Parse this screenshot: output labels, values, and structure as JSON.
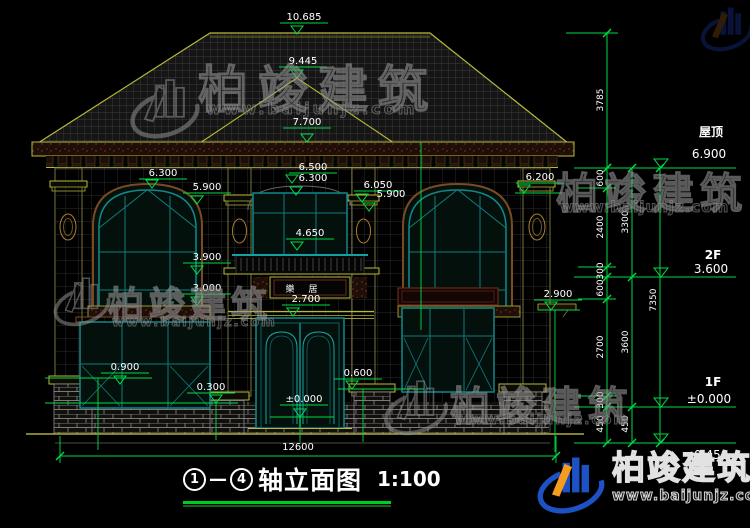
{
  "watermark": {
    "brand": "柏竣建筑",
    "url": "www.baijunjz.com"
  },
  "title": {
    "axis_start": "1",
    "separator": "—",
    "axis_end": "4",
    "name": "轴立面图",
    "scale": "1:100"
  },
  "plaque": {
    "char1": "樂",
    "char2": "居"
  },
  "colors": {
    "background": "#000000",
    "dimension_green": "#00dd44",
    "text_white": "#ffffff",
    "frame_teal": "#128989",
    "trim_olive": "#b9b93a",
    "brand_blue": "#1c52c4",
    "brand_orange": "#f59b1f",
    "watermark_gray": "#969696"
  },
  "annotations": {
    "spot_markers": [
      {
        "label": "10.685",
        "x": 304,
        "y": 20,
        "tx": 297,
        "ty": 34
      },
      {
        "label": "9.445",
        "x": 303,
        "y": 64,
        "tx": 297,
        "ty": 78
      },
      {
        "label": "7.700",
        "x": 307,
        "y": 125,
        "tx": 307,
        "ty": 142
      },
      {
        "label": "6.300",
        "x": 163,
        "y": 176,
        "tx": 152,
        "ty": 188
      },
      {
        "label": "5.900",
        "x": 207,
        "y": 190,
        "tx": 197,
        "ty": 204
      },
      {
        "label": "6.500",
        "x": 313,
        "y": 170,
        "tx": 292,
        "ty": 183
      },
      {
        "label": "6.300",
        "x": 313,
        "y": 181,
        "ul": false,
        "tx": 296,
        "ty": 195
      },
      {
        "label": "6.050",
        "x": 378,
        "y": 188,
        "tx": 362,
        "ty": 202
      },
      {
        "label": "5.900",
        "x": 391,
        "y": 197,
        "ul": false,
        "tx": 369,
        "ty": 211
      },
      {
        "label": "6.200",
        "x": 540,
        "y": 180,
        "tx": 524,
        "ty": 193
      },
      {
        "label": "4.650",
        "x": 310,
        "y": 236,
        "tx": 297,
        "ty": 250
      },
      {
        "label": "3.900",
        "x": 207,
        "y": 260,
        "tx": 197,
        "ty": 274
      },
      {
        "label": "3.000",
        "x": 207,
        "y": 291,
        "tx": 197,
        "ty": 305
      },
      {
        "label": "2.900",
        "x": 558,
        "y": 297,
        "tx": 551,
        "ty": 310
      },
      {
        "label": "2.700",
        "x": 306,
        "y": 302,
        "tx": 293,
        "ty": 316
      },
      {
        "label": "0.900",
        "x": 125,
        "y": 370,
        "tx": 120,
        "ty": 384
      },
      {
        "label": "0.300",
        "x": 211,
        "y": 390,
        "tx": 216,
        "ty": 403
      },
      {
        "label": "0.600",
        "x": 358,
        "y": 376,
        "tx": 352,
        "ty": 389
      },
      {
        "label": "±0.000",
        "x": 304,
        "y": 402,
        "tx": 300,
        "ty": 417
      }
    ],
    "levels": [
      {
        "name": "屋顶",
        "value": "6.900",
        "line_y": 168,
        "name_x": 711,
        "name_y": 136,
        "value_x": 709,
        "value_y": 158
      },
      {
        "name": "2F",
        "value": "3.600",
        "line_y": 277,
        "name_x": 713,
        "name_y": 259,
        "value_x": 711,
        "value_y": 273
      },
      {
        "name": "1F",
        "value": "±0.000",
        "line_y": 407,
        "name_x": 713,
        "name_y": 386,
        "value_x": 709,
        "value_y": 403
      },
      {
        "name": "",
        "value": "-0.450",
        "line_y": 443,
        "name_x": 0,
        "name_y": 0,
        "value_x": 709,
        "value_y": 459
      }
    ],
    "chains": [
      {
        "x": 607,
        "y1": 33,
        "y2": 168,
        "ticks": [
          33,
          168
        ],
        "labels": [
          {
            "text": "3785",
            "y": 100
          }
        ]
      },
      {
        "x": 607,
        "y1": 168,
        "y2": 443,
        "ticks": [
          168,
          188,
          267,
          277,
          299,
          396,
          407,
          443
        ],
        "labels": [
          {
            "text": "600",
            "y": 178
          },
          {
            "text": "2400",
            "y": 227
          },
          {
            "text": "300",
            "y": 271
          },
          {
            "text": "600",
            "y": 288
          },
          {
            "text": "2700",
            "y": 347
          },
          {
            "text": "300",
            "y": 400
          },
          {
            "text": "450",
            "y": 424
          }
        ]
      },
      {
        "x": 632,
        "y1": 168,
        "y2": 443,
        "ticks": [
          168,
          277,
          407,
          443
        ],
        "labels": [
          {
            "text": "3300",
            "y": 222
          },
          {
            "text": "3600",
            "y": 342
          },
          {
            "text": "450",
            "y": 424
          }
        ]
      },
      {
        "x": 660,
        "y1": 168,
        "y2": 443,
        "ticks": [
          168,
          443
        ],
        "labels": [
          {
            "text": "7350",
            "y": 300
          }
        ]
      }
    ],
    "ext_lines": [
      {
        "y": 33,
        "x1": 566,
        "x2": 618
      },
      {
        "y": 168,
        "x1": 574,
        "x2": 650
      },
      {
        "y": 188,
        "x1": 578,
        "x2": 616
      },
      {
        "y": 267,
        "x1": 578,
        "x2": 616
      },
      {
        "y": 277,
        "x1": 574,
        "x2": 650
      },
      {
        "y": 299,
        "x1": 578,
        "x2": 616
      },
      {
        "y": 396,
        "x1": 578,
        "x2": 616
      },
      {
        "y": 407,
        "x1": 574,
        "x2": 650
      },
      {
        "y": 443,
        "x1": 574,
        "x2": 650
      }
    ],
    "leader_lines": [
      {
        "x1": 45,
        "y1": 378,
        "x2": 152,
        "y2": 378
      },
      {
        "x1": 98,
        "y1": 378,
        "x2": 98,
        "y2": 450
      },
      {
        "x1": 45,
        "y1": 403,
        "x2": 238,
        "y2": 403
      },
      {
        "x1": 216,
        "y1": 403,
        "x2": 216,
        "y2": 440
      },
      {
        "x1": 515,
        "y1": 193,
        "x2": 562,
        "y2": 193
      },
      {
        "x1": 538,
        "y1": 310,
        "x2": 580,
        "y2": 310
      },
      {
        "x1": 555,
        "y1": 310,
        "x2": 555,
        "y2": 452
      },
      {
        "x1": 270,
        "y1": 417,
        "x2": 334,
        "y2": 417
      },
      {
        "x1": 300,
        "y1": 417,
        "x2": 300,
        "y2": 442
      },
      {
        "x1": 338,
        "y1": 389,
        "x2": 424,
        "y2": 389
      },
      {
        "x1": 363,
        "y1": 389,
        "x2": 363,
        "y2": 442
      },
      {
        "x1": 421,
        "y1": 142,
        "x2": 421,
        "y2": 330
      },
      {
        "x1": 60,
        "y1": 436,
        "x2": 60,
        "y2": 463
      },
      {
        "x1": 556,
        "y1": 436,
        "x2": 556,
        "y2": 463
      }
    ],
    "bottom_dim": {
      "label": "12600",
      "x1": 60,
      "x2": 556,
      "y": 456,
      "label_x": 298,
      "label_y": 450
    },
    "plain_texts": [
      {
        "text": "樂",
        "x": 290,
        "y": 292,
        "size": 9
      },
      {
        "text": "居",
        "x": 313,
        "y": 292,
        "size": 9
      }
    ]
  }
}
